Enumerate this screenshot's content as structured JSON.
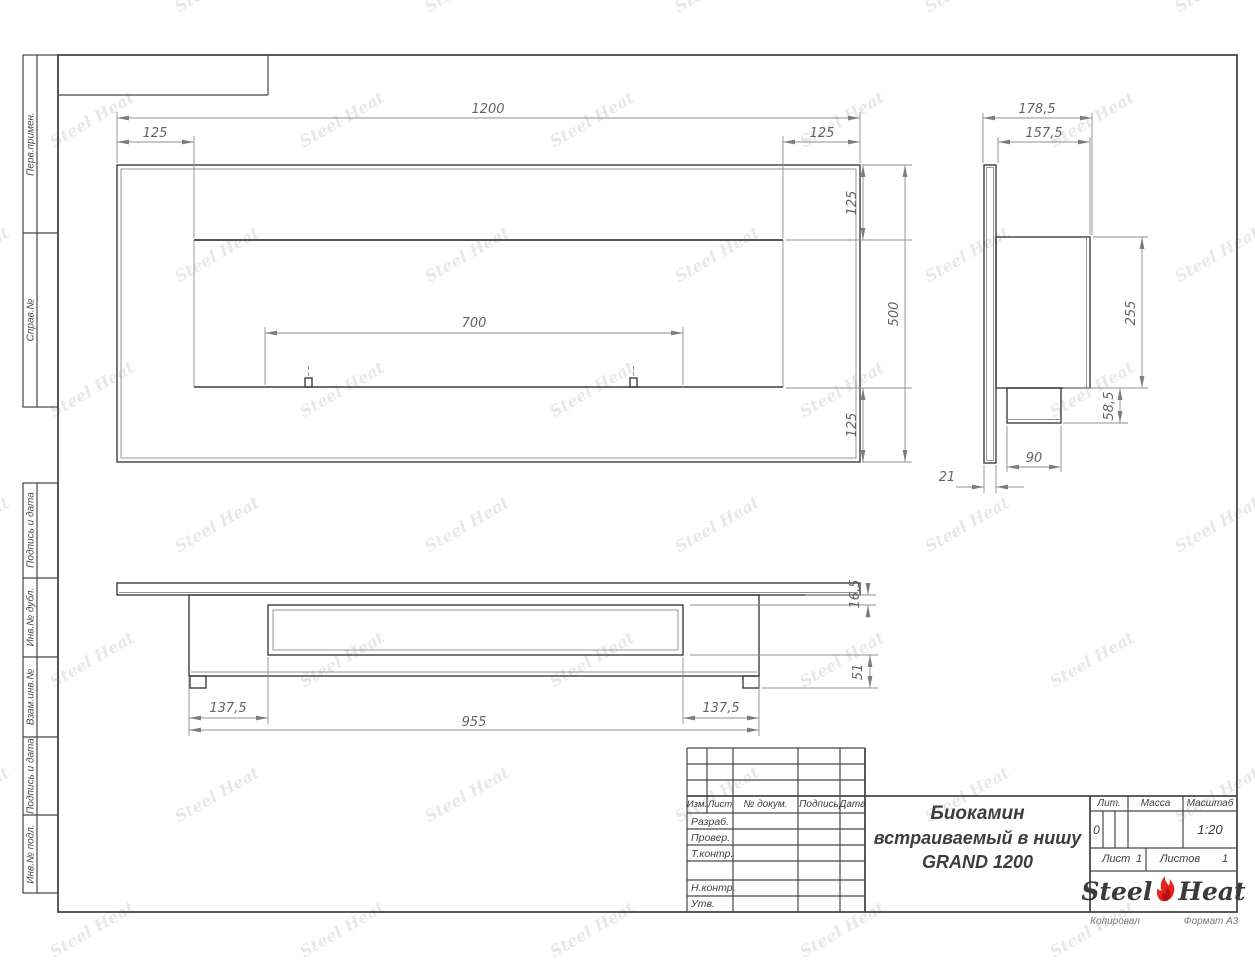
{
  "sheet": {
    "watermark": "Steel Heat",
    "copied_label": "Копировал",
    "format_label": "Формат А3"
  },
  "sidebar": {
    "top_labels": [
      "Перв.примен.",
      "Справ.№"
    ],
    "bottom_labels": [
      "Подпись и дата",
      "Инв.№ дубл.",
      "Взам.инв.№",
      "Подпись и дата",
      "Инв.№ подл."
    ]
  },
  "title_block": {
    "header_cols": [
      "Изм.",
      "Лист",
      "№ докум.",
      "Подпись",
      "Дата"
    ],
    "left_rows": [
      "Разраб.",
      "Провер.",
      "Т.контр.",
      "Н.контр.",
      "Утв."
    ],
    "doc_title_line1": "Биокамин",
    "doc_title_line2": "встраиваемый в нишу",
    "doc_title_line3": "GRAND 1200",
    "lit_header": "Лит.",
    "mass_header": "Масса",
    "scale_header": "Масштаб",
    "lit_value": "0",
    "scale_value": "1:20",
    "sheet_label": "Лист",
    "sheet_value": "1",
    "sheets_label": "Листов",
    "sheets_value": "1",
    "logo_steel": "Steel",
    "logo_heat": "Heat"
  },
  "dims": {
    "front_width": "1200",
    "front_left_offset": "125",
    "front_right_offset": "125",
    "front_burner": "700",
    "front_top_offset": "125",
    "front_bottom_offset": "125",
    "front_height": "500",
    "side_depth_total": "178,5",
    "side_depth_box": "157,5",
    "side_box_height": "255",
    "side_spigot_height": "58,5",
    "side_spigot_width": "90",
    "side_panel_thickness": "21",
    "bottom_left_offset": "137,5",
    "bottom_right_offset": "137,5",
    "bottom_body_width": "955",
    "bottom_gap": "16,5",
    "bottom_foot_height": "51"
  },
  "colors": {
    "line": "#3F3F3F",
    "dim": "#8F8F8F",
    "flame_red": "#E3261F",
    "watermark_gray": "#D9D9D9"
  }
}
